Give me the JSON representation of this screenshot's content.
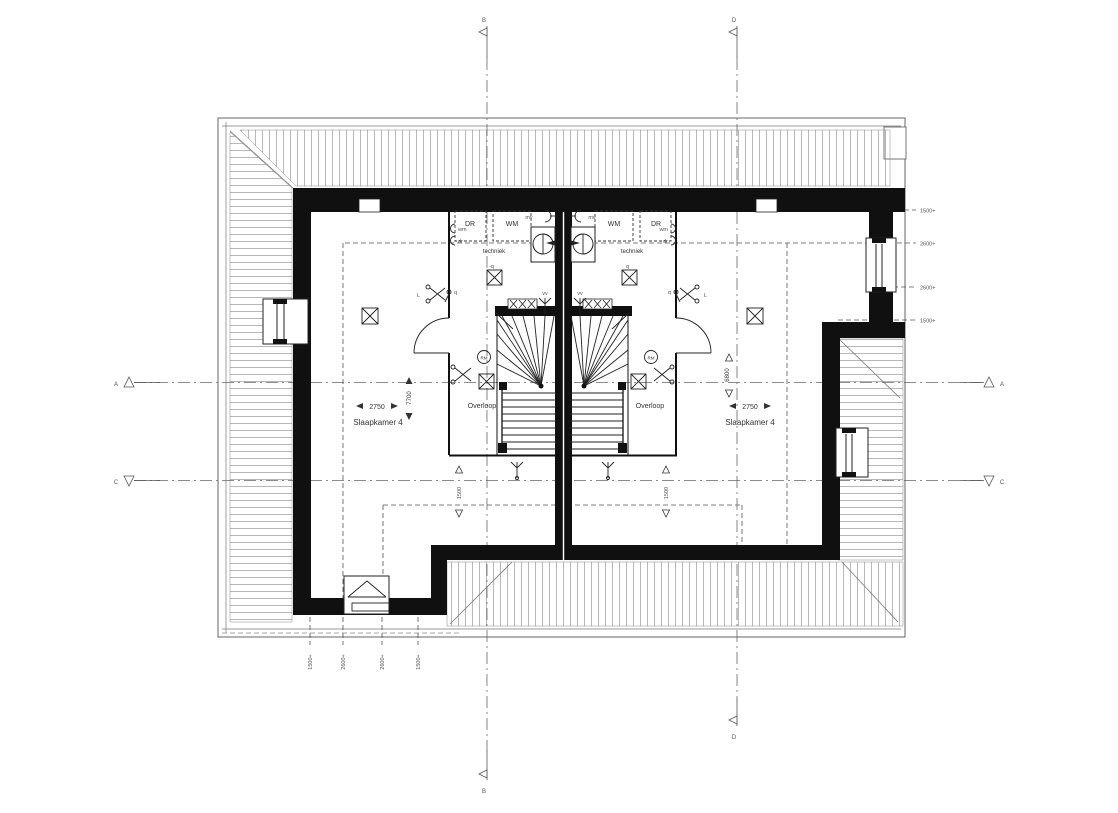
{
  "plan": {
    "grid": {
      "top_left": "B",
      "top_right": "D",
      "bottom_left": "B",
      "bottom_right": "D",
      "left_upper": "A",
      "left_lower": "C",
      "right_upper": "A",
      "right_lower": "C"
    },
    "heights_right": [
      "1500+",
      "2600+",
      "2600+",
      "1500+"
    ],
    "heights_bottom": [
      "1500+",
      "2600+",
      "2600+",
      "1500+"
    ],
    "units": {
      "left": {
        "bedroom": "Slaapkamer 4",
        "width": "2750",
        "depth": "7700",
        "landing": "Overloop",
        "landing_height": "1500",
        "tech": "techniek",
        "dryer": "DR",
        "washer": "WM",
        "conn_washer": "wm",
        "conn_dryer": "dr",
        "mech_vent": "mv",
        "vent_valve": "vv",
        "smoke_detector": "RM",
        "switch": "-q",
        "switch2": "q",
        "light": "L"
      },
      "right": {
        "bedroom": "Slaapkamer 4",
        "width": "2750",
        "depth": "6800",
        "landing": "Overloop",
        "landing_height": "1500",
        "tech": "techniek",
        "dryer": "DR",
        "washer": "WM",
        "conn_washer": "wm",
        "conn_dryer": "dr",
        "mech_vent": "mv",
        "vent_valve": "vv",
        "smoke_detector": "RM",
        "switch": "q",
        "switch2": "q",
        "light": "L"
      }
    }
  }
}
